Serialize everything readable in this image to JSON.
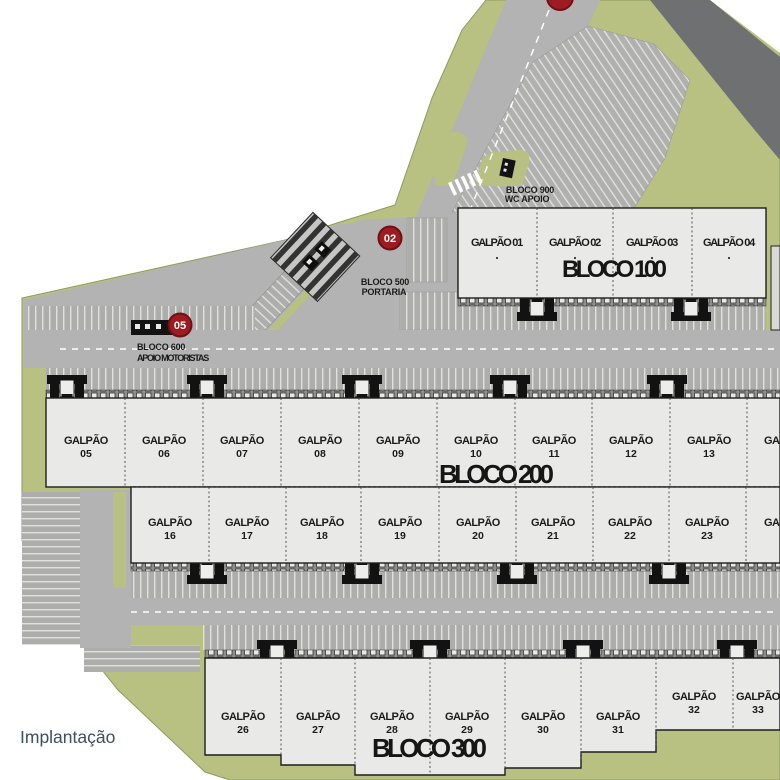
{
  "plan": {
    "caption": "Implantação",
    "colors": {
      "accent_red": "#9e1c21",
      "accent_red_ring": "#6e1014",
      "site_green": "#b8c181",
      "pavement": "#b2b3b2",
      "dark_road": "#6e7071",
      "building_fill": "#e9e9e7"
    },
    "badges": {
      "gate": "02",
      "drivers": "05"
    },
    "bloco100": {
      "title": "BLOCO 100",
      "units": [
        "GALPÃO 01",
        "GALPÃO 02",
        "GALPÃO 03",
        "GALPÃO 04"
      ]
    },
    "bloco200": {
      "title": "BLOCO 200",
      "row1": [
        {
          "name": "GALPÃO",
          "num": "05"
        },
        {
          "name": "GALPÃO",
          "num": "06"
        },
        {
          "name": "GALPÃO",
          "num": "07"
        },
        {
          "name": "GALPÃO",
          "num": "08"
        },
        {
          "name": "GALPÃO",
          "num": "09"
        },
        {
          "name": "GALPÃO",
          "num": "10"
        },
        {
          "name": "GALPÃO",
          "num": "11"
        },
        {
          "name": "GALPÃO",
          "num": "12"
        },
        {
          "name": "GALPÃO",
          "num": "13"
        },
        {
          "name": "GALPÃO",
          "num": "14"
        }
      ],
      "row2": [
        {
          "name": "GALPÃO",
          "num": "16"
        },
        {
          "name": "GALPÃO",
          "num": "17"
        },
        {
          "name": "GALPÃO",
          "num": "18"
        },
        {
          "name": "GALPÃO",
          "num": "19"
        },
        {
          "name": "GALPÃO",
          "num": "20"
        },
        {
          "name": "GALPÃO",
          "num": "21"
        },
        {
          "name": "GALPÃO",
          "num": "22"
        },
        {
          "name": "GALPÃO",
          "num": "23"
        },
        {
          "name": "GALPÃO",
          "num": "24"
        }
      ]
    },
    "bloco300": {
      "title": "BLOCO 300",
      "units": [
        {
          "name": "GALPÃO",
          "num": "26"
        },
        {
          "name": "GALPÃO",
          "num": "27"
        },
        {
          "name": "GALPÃO",
          "num": "28"
        },
        {
          "name": "GALPÃO",
          "num": "29"
        },
        {
          "name": "GALPÃO",
          "num": "30"
        },
        {
          "name": "GALPÃO",
          "num": "31"
        },
        {
          "name": "GALPÃO",
          "num": "32"
        },
        {
          "name": "GALPÃO",
          "num": "33"
        }
      ]
    },
    "bloco500": {
      "title": "BLOCO 500",
      "subtitle": "PORTARIA"
    },
    "bloco600": {
      "title": "BLOCO 600",
      "subtitle": "APOIO MOTORISTAS"
    },
    "bloco900": {
      "title": "BLOCO 900",
      "subtitle": "WC APOIO"
    }
  }
}
